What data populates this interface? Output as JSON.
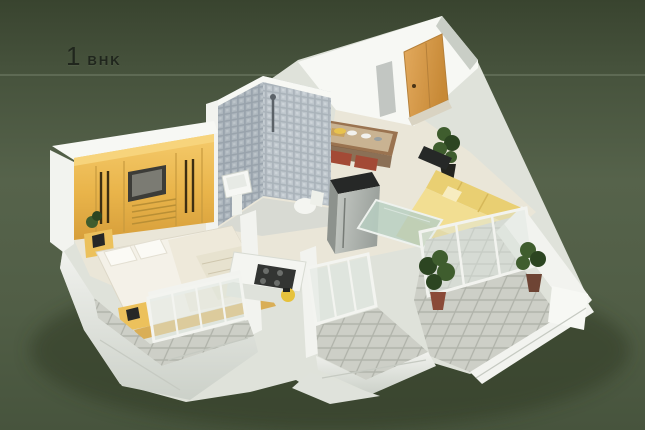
{
  "title": {
    "number": "1",
    "type": "BHK"
  },
  "palette": {
    "background_top": "#39442f",
    "background_upper": "#46523c",
    "background_mid": "#56634b",
    "background_lower": "#515e46",
    "background_bottom": "#47543d",
    "highlight_line": "rgba(220,230,205,0.16)",
    "title_color": "#20261d",
    "wall_white": "#f2f3ef",
    "wall_bright": "#f7f8f4",
    "wall_shade": "#dfe2da",
    "wall_shade_dark": "#c9cec6",
    "floor_cream": "#eae6d8",
    "wardrobe_yellow": "#ecb84e",
    "door_orange": "#d69a4a",
    "sofa_yellow": "#e9cf72",
    "nightstand_yellow": "#ecc15c",
    "tile_gray": "#c7c9c1",
    "mosaic_gray": "#a9b3ba",
    "plant_green": "#3f5d2e",
    "glass_green": "#dfe8e2",
    "dark_appliance": "#262827",
    "table_wood": "#9a7350",
    "chair_red": "#a34a36",
    "bed_white": "#f4f1e8"
  },
  "scene": {
    "type": "3d-isometric-floor-plan",
    "elements": [
      "bedroom",
      "wardrobe",
      "bed",
      "nightstands",
      "bathroom",
      "shower",
      "washbasin",
      "toilet",
      "entrance-door",
      "dining-counter",
      "refrigerator",
      "cooktop-counter",
      "living-room",
      "sofa",
      "coffee-table",
      "tv",
      "sliding-glass-door",
      "balconies",
      "potted-plants",
      "tiled-floors",
      "white-outer-walls"
    ]
  }
}
